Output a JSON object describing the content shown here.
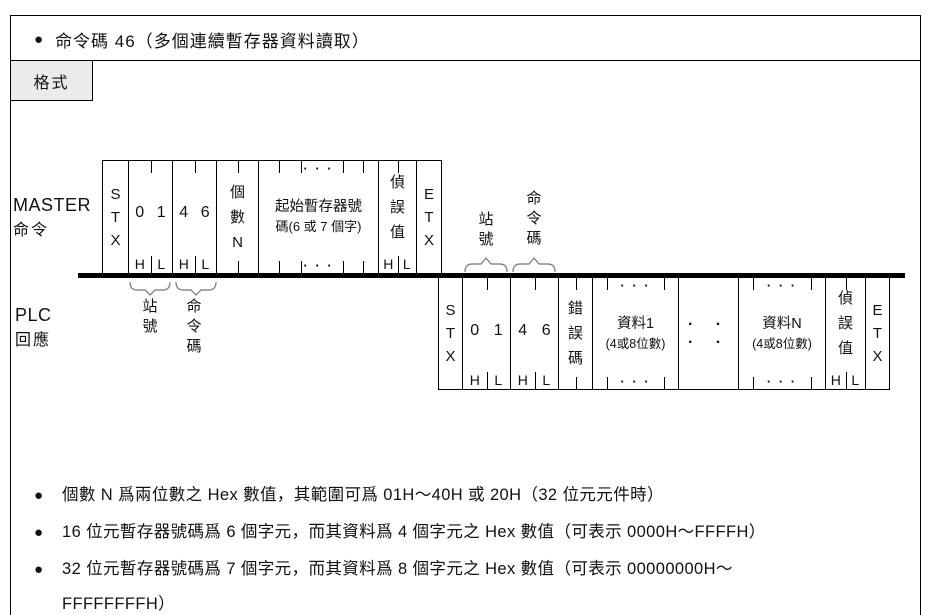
{
  "title": {
    "bullet": "●",
    "text": "命令碼 46（多個連續暫存器資料讀取）"
  },
  "tab": {
    "label": "格式"
  },
  "diagram": {
    "ellipsis3": "· · ·",
    "ellipsis4": "· · · ·",
    "master": {
      "label": {
        "line1": "MASTER",
        "line2": "命令"
      },
      "stx": "S\nT\nX",
      "d01": {
        "a": "0",
        "b": "1",
        "h": "H",
        "l": "L"
      },
      "d46": {
        "a": "4",
        "b": "6",
        "h": "H",
        "l": "L"
      },
      "count": "個\n數\nN",
      "start_reg": {
        "line1": "起始暫存器號",
        "line2": "碼(6 或 7 個字)"
      },
      "check": {
        "label": "偵\n誤\n值",
        "h": "H",
        "l": "L"
      },
      "etx": "E\nT\nX",
      "station": "站\n號",
      "command": "命\n令\n碼"
    },
    "plc": {
      "label": {
        "line1": "PLC",
        "line2": "回應"
      },
      "stx": "S\nT\nX",
      "d01": {
        "a": "0",
        "b": "1",
        "h": "H",
        "l": "L"
      },
      "d46": {
        "a": "4",
        "b": "6",
        "h": "H",
        "l": "L"
      },
      "error": "錯\n誤\n碼",
      "data1": {
        "line1": "資料1",
        "line2": "(4或8位數)"
      },
      "dataN": {
        "line1": "資料N",
        "line2": "(4或8位數)"
      },
      "check": {
        "label": "偵\n誤\n值",
        "h": "H",
        "l": "L"
      },
      "etx": "E\nT\nX",
      "station": "站\n號",
      "command": "命\n令\n碼"
    }
  },
  "notes": {
    "bullet": "●",
    "items": [
      {
        "text": "個數 N 爲兩位數之 Hex 數值，其範圍可爲 01H～40H 或 20H（32 位元元件時）"
      },
      {
        "text": "16 位元暫存器號碼爲 6 個字元，而其資料爲 4 個字元之 Hex 數值（可表示 0000H～FFFFH）"
      },
      {
        "text": "32 位元暫存器號碼爲 7 個字元，而其資料爲 8 個字元之 Hex 數值（可表示 00000000H～\nFFFFFFFFH）"
      }
    ]
  }
}
